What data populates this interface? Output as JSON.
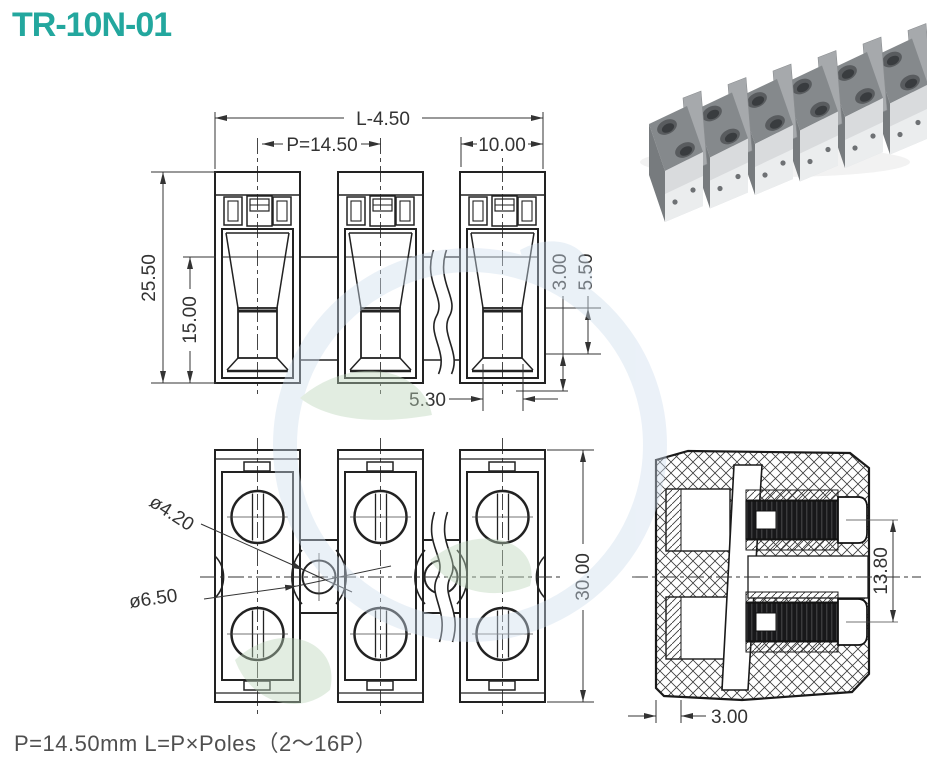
{
  "title": "TR-10N-01",
  "note": "P=14.50mm  L=P×Poles（2～16P）",
  "front_view": {
    "dims": {
      "overall_length": "L-4.50",
      "pitch": "P=14.50",
      "pole_width": "10.00",
      "overall_height": "25.50",
      "body_height": "15.00",
      "clamp_a": "3.00",
      "clamp_b": "5.50",
      "slot_width": "5.30"
    }
  },
  "plan_view": {
    "dims": {
      "screw_hole": "ø4.20",
      "mount_hole": "ø6.50",
      "depth": "30.00"
    }
  },
  "section_view": {
    "dims": {
      "contact_pitch": "13.80",
      "wall": "3.00"
    }
  },
  "colors": {
    "accent": "#23a79e",
    "line": "#222222",
    "dim_text": "#333333",
    "note_text": "#4f4f4f",
    "watermark_blue": "#cfdeee",
    "watermark_green": "#bcd6ba"
  }
}
